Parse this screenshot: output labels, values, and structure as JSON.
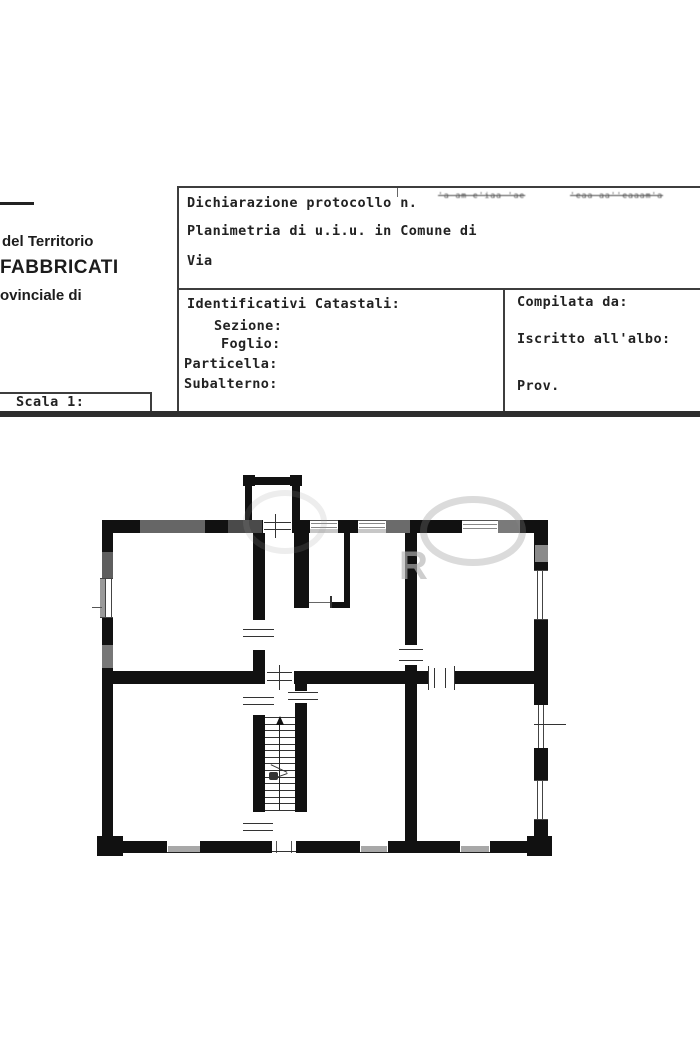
{
  "document": {
    "left_panel": {
      "line1": "del Territorio",
      "line2": "FABBRICATI",
      "line3": "ovinciale di",
      "scale_label": "Scala 1:"
    },
    "declaration": {
      "label": "Dichiarazione protocollo n.",
      "scribble_a": "'a am e'iaa 'ae",
      "scribble_b": "'eaa aa''eaaam'a"
    },
    "planimetria_label": "Planimetria di u.i.u. in Comune di",
    "via_label": "Via",
    "cadastral": {
      "title": "Identificativi Catastali:",
      "sezione": "Sezione:",
      "foglio": "Foglio:",
      "particella": "Particella:",
      "subalterno": "Subalterno:"
    },
    "compiler": {
      "compilata": "Compilata da:",
      "iscritto": "Iscritto all'albo:",
      "prov": "Prov."
    },
    "watermark_letter": "R"
  },
  "colors": {
    "wall": "#111111",
    "text": "#222222",
    "form_line": "#3d3d3d",
    "threshold_gray": "#a8a8a8",
    "watermark_gray": "#b4b4b4"
  }
}
